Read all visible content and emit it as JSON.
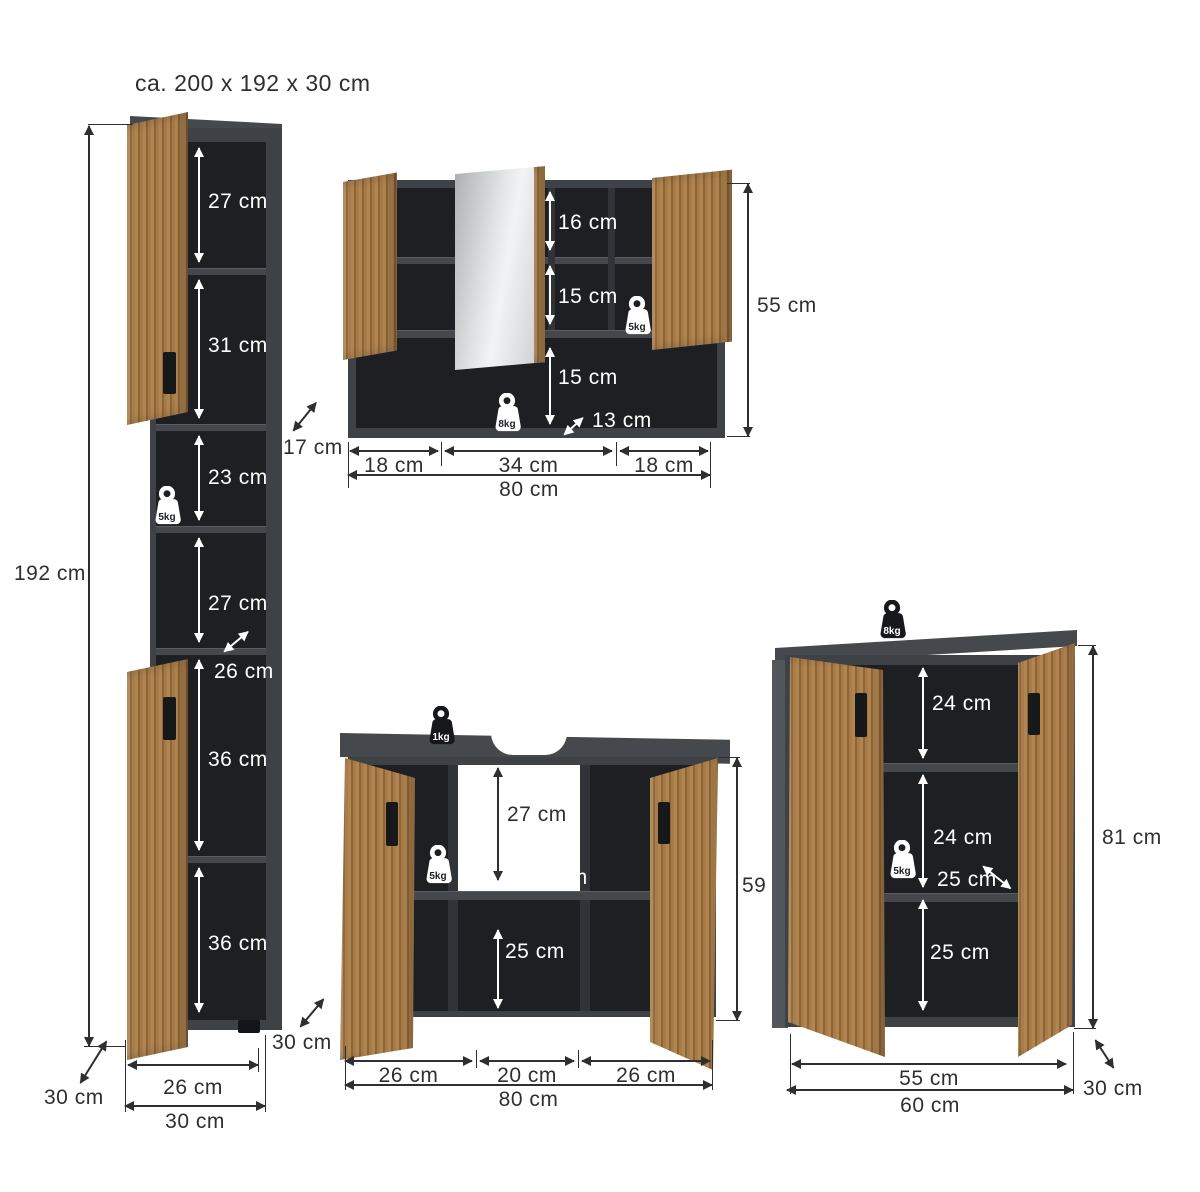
{
  "title": "ca. 200 x 192 x 30 cm",
  "colors": {
    "background": "#ffffff",
    "carcass_gray": "#3e4146",
    "interior_dark": "#1d1f22",
    "wood_oak": "#a87c49",
    "dimension_line": "#2e2f31",
    "dimension_text_light": "#ffffff"
  },
  "tall_cabinet": {
    "height": "192 cm",
    "s1": "27 cm",
    "s2": "31 cm",
    "s3": "23 cm",
    "s4": "27 cm",
    "s5": "36 cm",
    "s6": "36 cm",
    "load_shelf": "5kg",
    "depth_mid": "26 cm",
    "width_inner": "26 cm",
    "width_outer": "30 cm",
    "depth": "30 cm"
  },
  "mirror_cabinet": {
    "s1": "16 cm",
    "s2": "15 cm",
    "s3": "15 cm",
    "load_shelf": "5kg",
    "load_bottom": "8kg",
    "depth_side": "17 cm",
    "depth_bottom": "13 cm",
    "height": "55 cm",
    "w1": "18 cm",
    "w2": "34 cm",
    "w3": "18 cm",
    "width_total": "80 cm"
  },
  "sink_cabinet": {
    "load_top": "1kg",
    "load_shelf": "5kg",
    "s1": "27 cm",
    "depth_mid": "25 cm",
    "s2": "25 cm",
    "height": "59 cm",
    "w1": "26 cm",
    "w2": "20 cm",
    "w3": "26 cm",
    "width_total": "80 cm",
    "depth": "30 cm"
  },
  "side_cabinet": {
    "load_top": "8kg",
    "load_shelf": "5kg",
    "s1": "24 cm",
    "s2": "24 cm",
    "depth_mid": "25 cm",
    "s3": "25 cm",
    "height": "81 cm",
    "width_inner": "55 cm",
    "width_outer": "60 cm",
    "depth": "30 cm"
  }
}
